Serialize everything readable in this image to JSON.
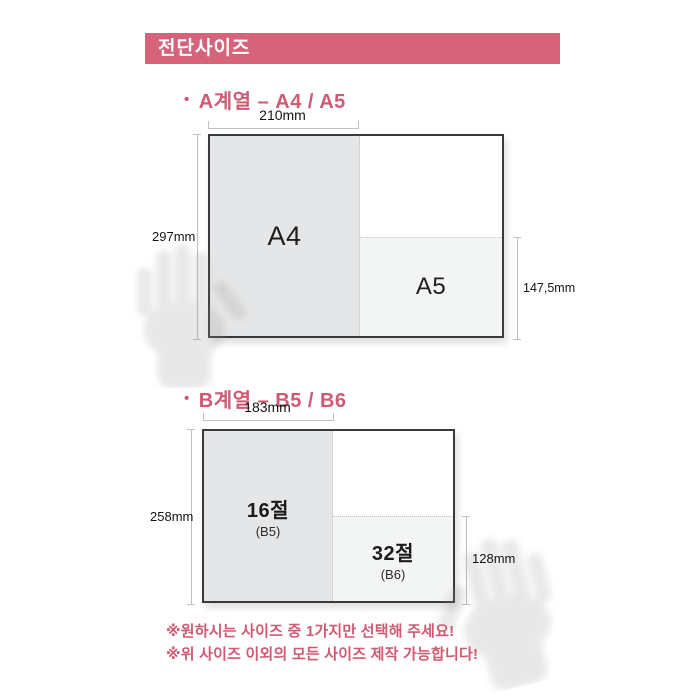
{
  "header": {
    "title": "전단사이즈"
  },
  "colors": {
    "accent_bar": "#d5637a",
    "accent_text": "#cf5a72",
    "sheet_border": "#3a3a3c",
    "fill_large": "#e5e6e7",
    "fill_small": "#f3f4f4",
    "measure_line": "#bfbfbf"
  },
  "sections": [
    {
      "bullet": "•",
      "title": "A계열 – A4 / A5",
      "diagram": {
        "width_label": "210mm",
        "height_label": "297mm",
        "small_height_label": "147,5mm",
        "large_region": {
          "label": "A4"
        },
        "small_region": {
          "label": "A5"
        }
      }
    },
    {
      "bullet": "•",
      "title": "B계열 – B5 / B6",
      "diagram": {
        "width_label": "183mm",
        "height_label": "258mm",
        "small_height_label": "128mm",
        "large_region": {
          "label": "16절",
          "sub": "(B5)"
        },
        "small_region": {
          "label": "32절",
          "sub": "(B6)"
        }
      }
    }
  ],
  "notes": [
    "※원하시는 사이즈 중 1가지만 선택해 주세요!",
    "※위 사이즈 이외의 모든 사이즈 제작 가능합니다!"
  ]
}
